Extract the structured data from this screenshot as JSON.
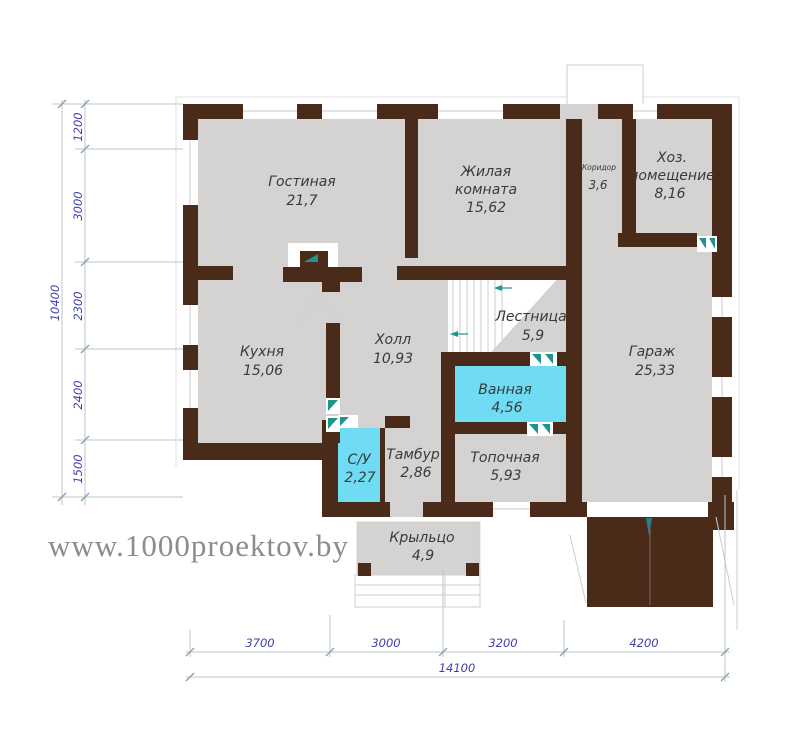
{
  "watermark": "www.1000proektov.by",
  "colors": {
    "wall": "#4a2a18",
    "floor": "#d5d3d2",
    "wet_room": "#6fdcf3",
    "door_marker": "#1f948c",
    "dim_line": "#b9c6cb",
    "dim_text": "#3f3fb0",
    "room_text": "#3a3a3a",
    "watermark": "#8c8c8c"
  },
  "rooms": {
    "gostinaya": {
      "name": "Гостиная",
      "area": "21,7"
    },
    "zhilaya": {
      "name_line1": "Жилая",
      "name_line2": "комната",
      "area": "15,62"
    },
    "koridor": {
      "name": "Коридор",
      "area": "3,6"
    },
    "khoz": {
      "name_line1": "Хоз.",
      "name_line2": "помещение",
      "area": "8,16"
    },
    "kukhnya": {
      "name": "Кухня",
      "area": "15,06"
    },
    "kholl": {
      "name": "Холл",
      "area": "10,93"
    },
    "lestnitsa": {
      "name": "Лестница",
      "area": "5,9"
    },
    "garazh": {
      "name": "Гараж",
      "area": "25,33"
    },
    "vannaya": {
      "name": "Ванная",
      "area": "4,56"
    },
    "su": {
      "name": "С/У",
      "area": "2,27"
    },
    "tambur": {
      "name": "Тамбур",
      "area": "2,86"
    },
    "topochnaya": {
      "name": "Топочная",
      "area": "5,93"
    },
    "kryltso": {
      "name": "Крыльцо",
      "area": "4,9"
    }
  },
  "dimensions": {
    "vertical": {
      "total": "10400",
      "segments": [
        "1200",
        "3000",
        "2300",
        "2400",
        "1500"
      ]
    },
    "horizontal": {
      "total": "14100",
      "segments": [
        "3700",
        "3000",
        "3200",
        "4200"
      ]
    }
  }
}
